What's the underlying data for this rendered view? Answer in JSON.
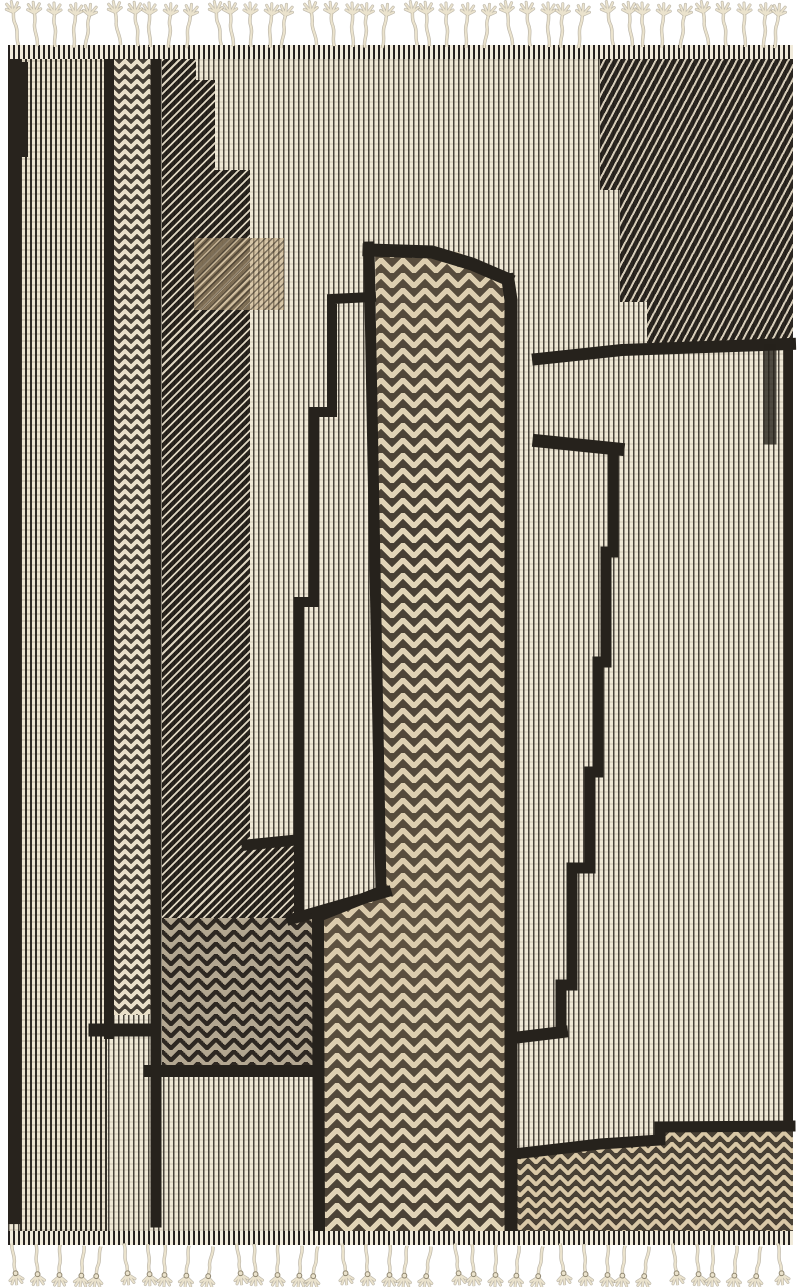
{
  "meta": {
    "type": "product-photo",
    "subject": "flatweave kilim rug",
    "alt": "Black and ivory hand-woven flatweave rug with abstract geometric column pattern, herringbone and pinstripe textures, and knotted tassel fringe at top and bottom"
  },
  "palette": {
    "page_bg": "#ffffff",
    "ink": "#26221c",
    "cream": "#efe8d6",
    "cream_dark": "#ece4d0",
    "herringbone_cream": "#e4d8bc",
    "tan": "#d9c8a6",
    "fringe": "#ebe3cd",
    "fringe_shadow": "#8f8670",
    "binding_bg": "#f1ebdb"
  },
  "fringe": {
    "top_count": 40,
    "bottom_count": 36
  },
  "blocks": [
    {
      "name": "base-field",
      "tex": "pinstripe-light",
      "x": 8,
      "y": 59,
      "w": 785,
      "h": 1172
    },
    {
      "name": "left-field",
      "tex": "pinstripe-dark",
      "x": 20,
      "y": 59,
      "w": 87,
      "h": 1172
    },
    {
      "name": "left-border",
      "tex": "solid",
      "x": 8,
      "y": 59,
      "w": 13,
      "h": 1165
    },
    {
      "name": "left-corner-blob",
      "tex": "solid",
      "x": 8,
      "y": 62,
      "w": 20,
      "h": 95
    },
    {
      "name": "right-border",
      "tex": "solid",
      "x": 784,
      "y": 59,
      "w": 9,
      "h": 1172
    },
    {
      "name": "herringbone-column-left",
      "tex": "herringbone-light",
      "x": 113,
      "y": 59,
      "w": 39,
      "h": 956
    },
    {
      "name": "dark-hatch-column",
      "tex": "hatch-dark",
      "x": 162,
      "y": 59,
      "w": 155,
      "h": 1007,
      "clip": [
        [
          0,
          0
        ],
        [
          34,
          0
        ],
        [
          34,
          21
        ],
        [
          53,
          21
        ],
        [
          53,
          111
        ],
        [
          88,
          111
        ],
        [
          88,
          786
        ],
        [
          133,
          786
        ],
        [
          133,
          859
        ],
        [
          155,
          859
        ],
        [
          155,
          1007
        ],
        [
          0,
          1007
        ]
      ]
    },
    {
      "name": "tan-patch",
      "tex": "tan-hatch",
      "x": 194,
      "y": 238,
      "w": 90,
      "h": 72
    },
    {
      "name": "dark-chevron-block",
      "tex": "herringbone-dark",
      "x": 162,
      "y": 918,
      "w": 153,
      "h": 148
    },
    {
      "name": "top-right-hatch",
      "tex": "hatch-shallow",
      "x": 545,
      "y": 59,
      "w": 248,
      "h": 292,
      "clip": [
        [
          55,
          0
        ],
        [
          248,
          0
        ],
        [
          248,
          284
        ],
        [
          102,
          284
        ],
        [
          102,
          243
        ],
        [
          75,
          243
        ],
        [
          75,
          131
        ],
        [
          55,
          131
        ]
      ]
    },
    {
      "name": "center-tower",
      "tex": "herringbone-mid",
      "x": 315,
      "y": 243,
      "w": 200,
      "h": 989,
      "clip": [
        [
          60,
          2
        ],
        [
          143,
          9
        ],
        [
          197,
          34
        ],
        [
          197,
          989
        ],
        [
          5,
          989
        ],
        [
          3,
          823
        ],
        [
          2,
          675
        ],
        [
          68,
          650
        ]
      ]
    },
    {
      "name": "bottom-right-band",
      "tex": "herringbone-tan",
      "x": 512,
      "y": 1120,
      "w": 281,
      "h": 112,
      "clip": [
        [
          0,
          35
        ],
        [
          88,
          24
        ],
        [
          148,
          20
        ],
        [
          148,
          6
        ],
        [
          281,
          6
        ],
        [
          281,
          112
        ],
        [
          0,
          112
        ]
      ]
    }
  ],
  "lines": [
    {
      "name": "black-line-a",
      "d": "M109 59 L109 1034",
      "w": 10
    },
    {
      "name": "black-line-b",
      "d": "M156 59 L156 1222",
      "w": 11
    },
    {
      "name": "chevron-col-cap",
      "d": "M95 1030 L154 1030",
      "w": 13
    },
    {
      "name": "hatch-col-cap",
      "d": "M150 1071 L316 1071",
      "w": 12
    },
    {
      "name": "inner-panel-outline",
      "d": "M371 297 L332 299 L332 412 L314 412 L314 602 L299 602 L299 917",
      "w": 10
    },
    {
      "name": "inner-panel-bottom",
      "d": "M292 919 L386 892",
      "w": 11
    },
    {
      "name": "stripe-strip-cap",
      "d": "M247 845 L296 840",
      "w": 11
    },
    {
      "name": "notch-bar",
      "d": "M539 441 L618 449",
      "w": 13
    },
    {
      "name": "jagged-right-line",
      "d": "M613 449 L613 552 L606 552 L606 662 L598 662 L598 772 L590 772 L590 868 L572 868 L572 985 L561 985 L561 1031",
      "w": 11
    },
    {
      "name": "jagged-line-cap",
      "d": "M562 1032 L513 1038",
      "w": 12
    },
    {
      "name": "mid-band-line",
      "d": "M538 359 L622 350 L790 344",
      "w": 12
    },
    {
      "name": "bottom-band-edge",
      "d": "M514 1154 L600 1144 L660 1140 L660 1127 L790 1126",
      "w": 11
    },
    {
      "name": "tower-top-edge",
      "d": "M369 250 L432 252 L472 264 L507 279",
      "w": 13
    },
    {
      "name": "tower-right-edge",
      "d": "M508 280 L511 300 L511 1231",
      "w": 13
    },
    {
      "name": "tower-left-edge",
      "d": "M369 247 L381 890",
      "w": 11
    },
    {
      "name": "tower-left-jog",
      "d": "M382 891 L317 917",
      "w": 11
    },
    {
      "name": "tower-lower-left-edge",
      "d": "M318 917 L319 1231",
      "w": 12
    },
    {
      "name": "right-dark-streak",
      "d": "M770 350 L770 438",
      "w": 13,
      "opacity": 0.8
    }
  ]
}
